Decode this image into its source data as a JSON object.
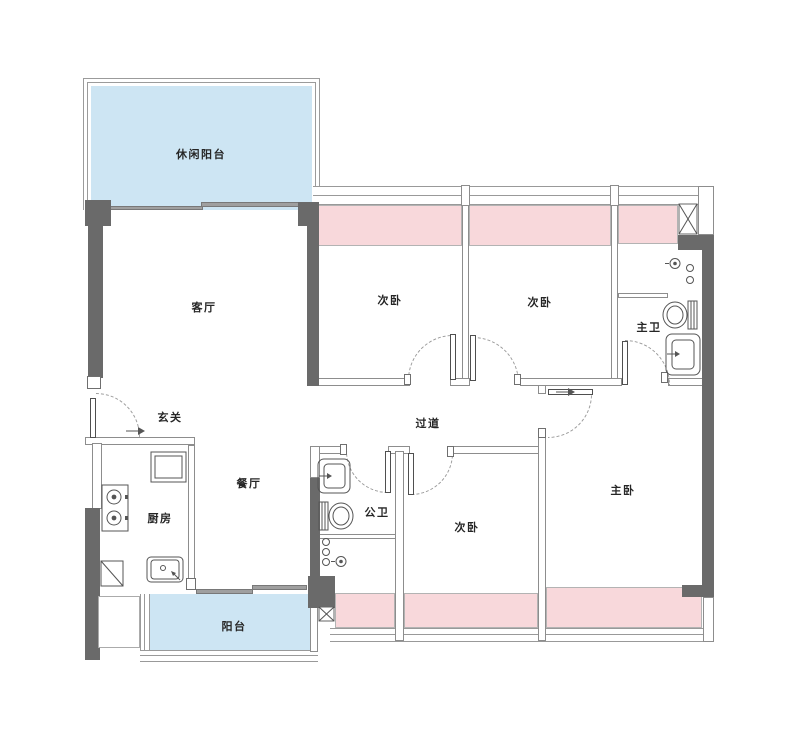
{
  "floor_plan": {
    "rooms": [
      {
        "id": "leisure-balcony",
        "label": "休闲阳台"
      },
      {
        "id": "living-room",
        "label": "客厅"
      },
      {
        "id": "foyer",
        "label": "玄关"
      },
      {
        "id": "dining-room",
        "label": "餐厅"
      },
      {
        "id": "kitchen",
        "label": "厨房"
      },
      {
        "id": "balcony",
        "label": "阳台"
      },
      {
        "id": "bedroom-top-left",
        "label": "次卧"
      },
      {
        "id": "bedroom-top-right",
        "label": "次卧"
      },
      {
        "id": "master-bath",
        "label": "主卫"
      },
      {
        "id": "hallway",
        "label": "过道"
      },
      {
        "id": "public-bath",
        "label": "公卫"
      },
      {
        "id": "bedroom-bottom",
        "label": "次卧"
      },
      {
        "id": "master-bedroom",
        "label": "主卧"
      }
    ],
    "colors": {
      "balcony_fill": "#cde5f3",
      "bay_window_fill": "#f8d8db",
      "structural_wall": "#6a6a6a",
      "line": "#9b9b9b"
    }
  }
}
